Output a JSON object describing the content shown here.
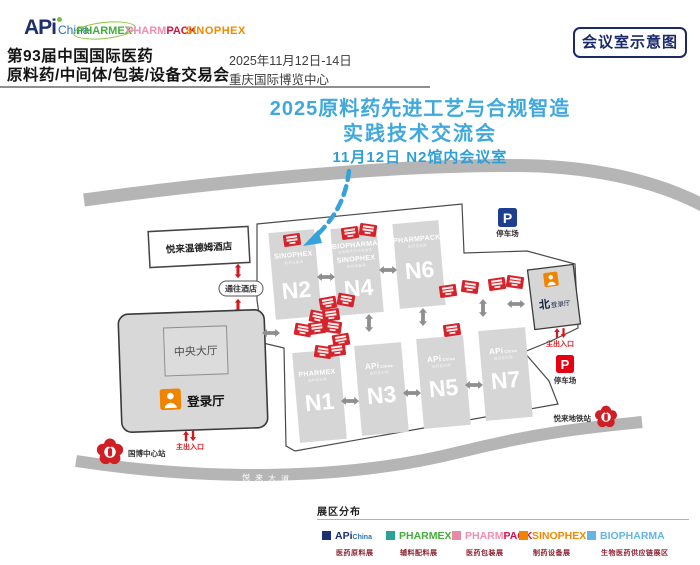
{
  "header": {
    "logo_api_a": "APi",
    "logo_api_b": "China",
    "logo_pharmex": "PHARMEX",
    "logo_pharmpack_a": "PHARM",
    "logo_pharmpack_b": "PACK",
    "logo_sinophex": "SINOPHEX",
    "title_line1": "第93届中国国际医药",
    "title_line2": "原料药/中间体/包装/设备交易会",
    "date": "2025年11月12日-14日",
    "venue": "重庆国际博览中心",
    "corner_badge": "会议室示意图"
  },
  "announcement": {
    "line1": "2025原料药先进工艺与合规智造",
    "line2": "实践技术交流会",
    "line3": "11月12日  N2馆内会议室",
    "accent_color": "#3fa8dc"
  },
  "map": {
    "road_top": "悦来滨江路",
    "road_bottom": "悦来大道",
    "hotel": "悦来温德姆酒店",
    "to_hotel": "通往酒店",
    "central_hall": "中央大厅",
    "registration_hall": "登录厅",
    "north_reg_prefix": "北",
    "north_reg_label": "登录厅",
    "main_exit_left": "主出入口",
    "main_exit_right": "主出入口",
    "parking_symbol": "P",
    "parking_top": "停车场",
    "parking_right": "停车场",
    "metro_left_station": "国博中心站",
    "metro_right_station": "悦来地铁站",
    "halls": {
      "n2": {
        "num": "N2",
        "logo": "SINOPHEX",
        "sub": "制药设备展"
      },
      "n4": {
        "num": "N4",
        "logo_top": "BIOPHARMA",
        "sub_top": "生物医药供应链展区",
        "logo": "SINOPHEX",
        "sub": "制药设备展"
      },
      "n6": {
        "num": "N6",
        "logo": "PHARMPACK",
        "sub": "医药包装展"
      },
      "n1": {
        "num": "N1",
        "logo": "PHARMEX",
        "sub": "辅料配料展"
      },
      "n3": {
        "num": "N3",
        "logo_a": "APi",
        "logo_b": "China",
        "sub": "医药原料展"
      },
      "n5": {
        "num": "N5",
        "logo_a": "APi",
        "logo_b": "China",
        "sub": "医药原料展"
      },
      "n7": {
        "num": "N7",
        "logo_a": "APi",
        "logo_b": "China",
        "sub": "医药原料展"
      }
    },
    "colors": {
      "hall_fill": "#d6d6d6",
      "road": "#b5b5b5",
      "marker_red": "#d5232b",
      "accent_navy": "#1c2f6e",
      "arrow_blue": "#35a3d8",
      "reg_orange": "#f08300"
    }
  },
  "legend": {
    "title": "展区分布",
    "items": [
      {
        "logo_a": "APi",
        "logo_b": "China",
        "sub": "医药原料展",
        "color": "#1c2f6e"
      },
      {
        "logo_a": "PHARMEX",
        "logo_b": "",
        "sub": "辅料配料展",
        "color": "#2aa396"
      },
      {
        "logo_a": "PHARM",
        "logo_b": "PACK",
        "sub": "医药包装展",
        "color": "#e989a8"
      },
      {
        "logo_a": "SINOPHEX",
        "logo_b": "",
        "sub": "制药设备展",
        "color": "#f08300"
      },
      {
        "logo_a": "BIOPHARMA",
        "logo_b": "",
        "sub": "生物医药供应链展区",
        "color": "#62b5e5"
      }
    ]
  }
}
